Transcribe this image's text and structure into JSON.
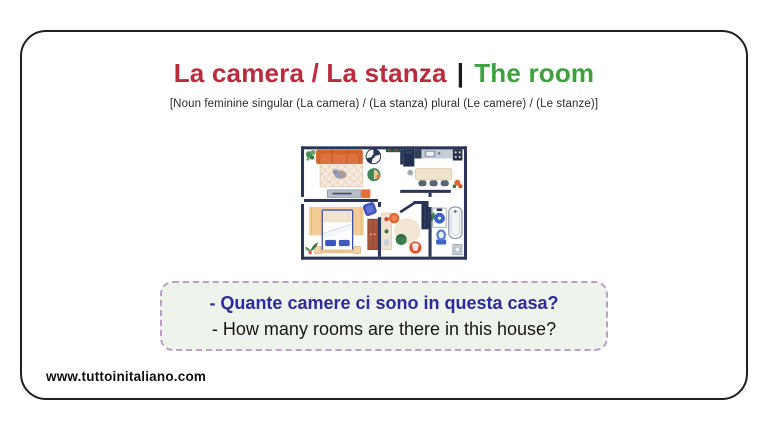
{
  "header": {
    "title_italian": "La camera / La stanza",
    "separator": "|",
    "title_english": "The room",
    "grammar_note": "[Noun feminine singular (La camera) / (La stanza) plural (Le camere) / (Le stanze)]"
  },
  "floor_plan": {
    "illustration": "apartment-floor-plan",
    "rooms": [
      "living room",
      "kitchen",
      "bedroom",
      "hallway",
      "bathroom"
    ]
  },
  "question_box": {
    "italian": "- Quante camere ci sono in questa casa?",
    "english": "- How many rooms are there in this house?"
  },
  "footer": {
    "website": "www.tuttoinitaliano.com"
  },
  "colors": {
    "title_red": "#BB2B3C",
    "title_green": "#3CA13E",
    "question_blue": "#2E2B9D",
    "box_background": "#EEF3EC",
    "box_border_dash": "#BD9EC4",
    "card_border": "#202020",
    "plan_wall_navy": "#2A3557",
    "sofa_orange": "#DD7340"
  }
}
